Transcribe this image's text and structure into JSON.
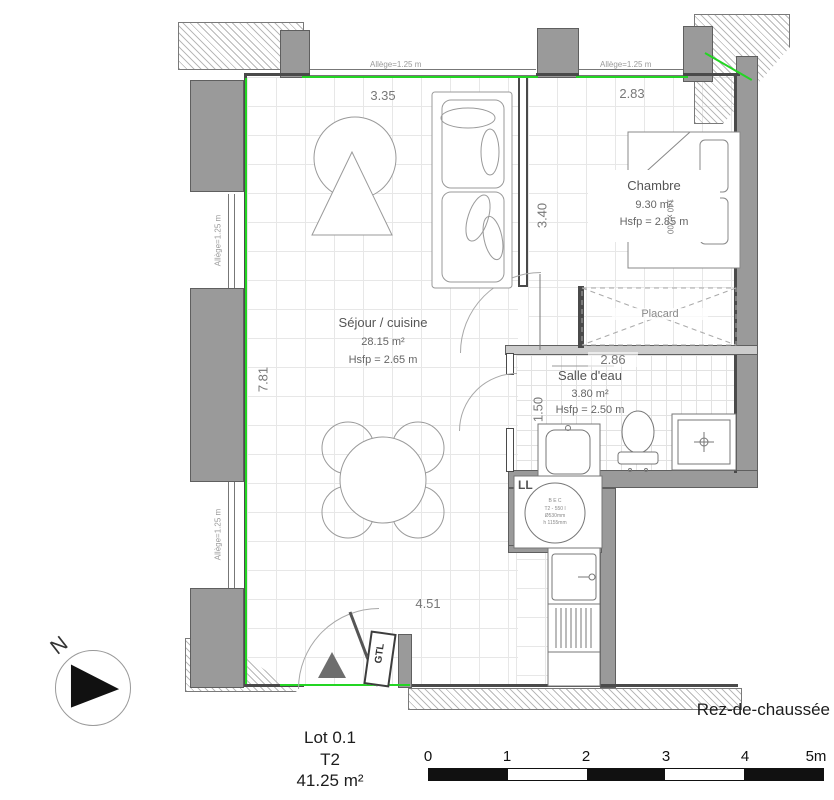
{
  "meta": {
    "floor_label": "Rez-de-chaussée",
    "north_label": "N"
  },
  "title_block": {
    "lot": "Lot 0.1",
    "type": "T2",
    "area": "41.25 m²"
  },
  "rooms": {
    "sejour": {
      "name": "Séjour / cuisine",
      "area": "28.15 m²",
      "ceiling": "Hsfp = 2.65 m"
    },
    "chambre": {
      "name": "Chambre",
      "area": "9.30 m²",
      "ceiling": "Hsfp = 2.85 m"
    },
    "salle_eau": {
      "name": "Salle d'eau",
      "area": "3.80 m²",
      "ceiling": "Hsfp = 2.50 m"
    },
    "placard": {
      "name": "Placard"
    }
  },
  "annotations": {
    "gtl": "GTL",
    "washer": "LL",
    "washer_drum": "B E C",
    "washer_spec1": "T2 - 550 l",
    "washer_spec2": "Ø530mm",
    "washer_spec3": "h 1155mm",
    "bed_size": "140 x 200"
  },
  "dimensions": {
    "top_left": "3.35",
    "top_right": "2.83",
    "left": "7.81",
    "bottom": "4.51",
    "chambre_depth": "3.40",
    "salle_eau_width": "2.86",
    "salle_eau_depth": "1.50",
    "allege_top_left": "Allège=1.25 m",
    "allege_top_right": "Allège=1.25 m",
    "allege_left_upper": "Allège=1.25 m",
    "allege_left_lower": "Allège=1.25 m"
  },
  "scale_bar": {
    "labels": [
      "0",
      "1",
      "2",
      "3",
      "4",
      "5m"
    ]
  },
  "colors": {
    "boundary_green": "#23d523",
    "wall_gray": "#9a9a9a",
    "line_dark": "#4a4a4a"
  }
}
